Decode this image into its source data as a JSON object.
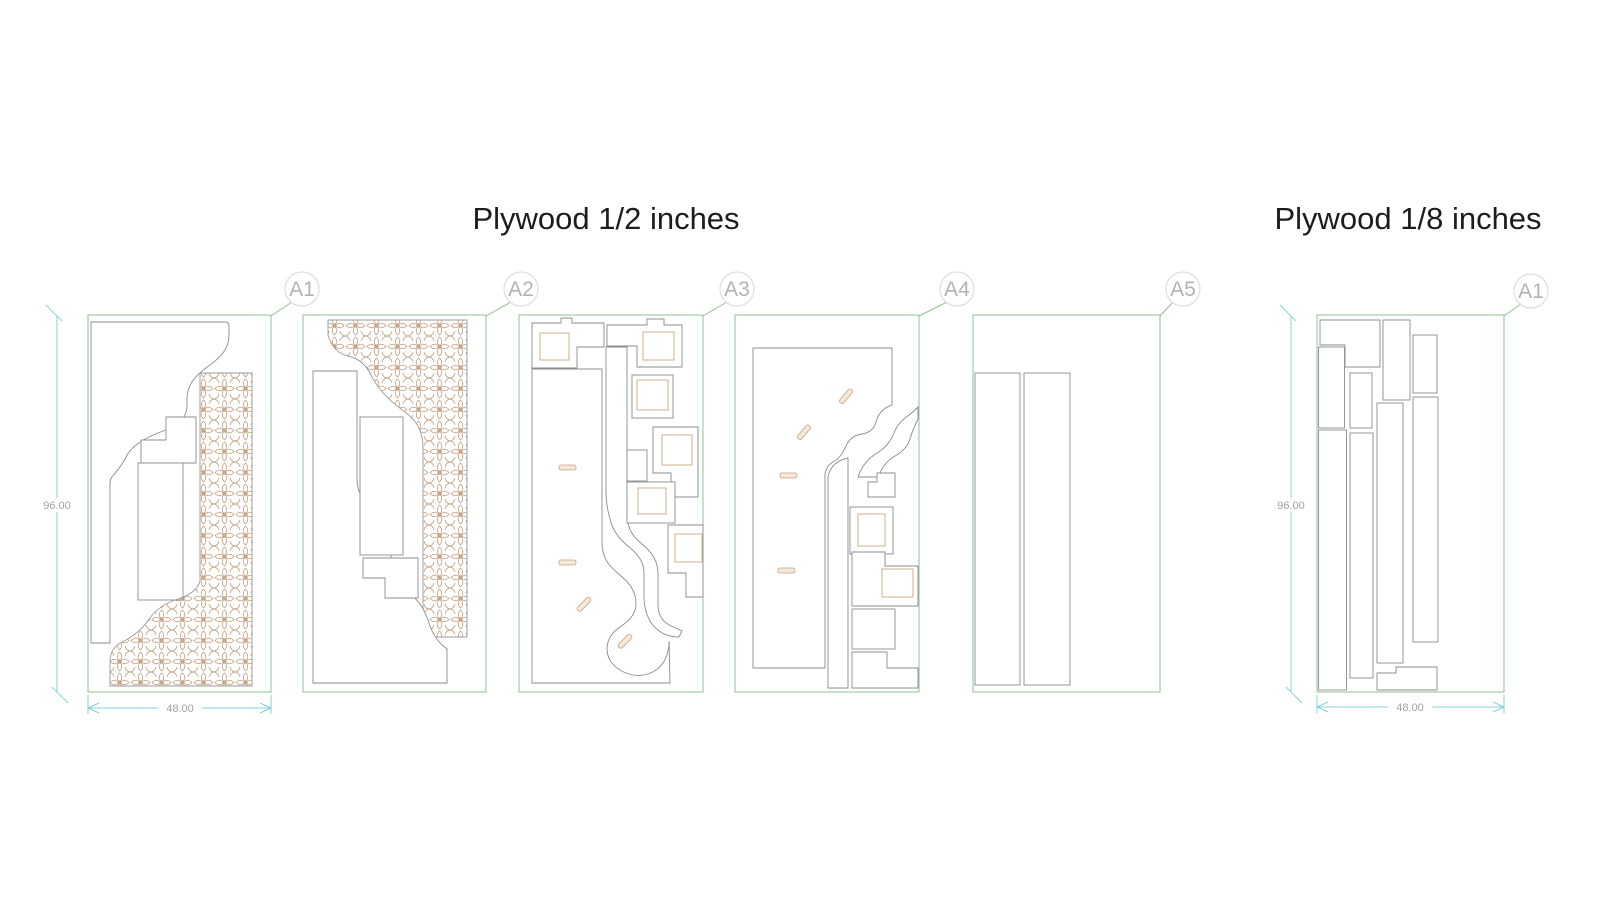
{
  "titles": {
    "left": "Plywood 1/2 inches",
    "right": "Plywood 1/8 inches"
  },
  "sheets": [
    {
      "id": "a1",
      "label": "A1",
      "group": "plywood-half-inch"
    },
    {
      "id": "a2",
      "label": "A2",
      "group": "plywood-half-inch"
    },
    {
      "id": "a3",
      "label": "A3",
      "group": "plywood-half-inch"
    },
    {
      "id": "a4",
      "label": "A4",
      "group": "plywood-half-inch"
    },
    {
      "id": "a5",
      "label": "A5",
      "group": "plywood-half-inch"
    },
    {
      "id": "r1",
      "label": "A1",
      "group": "plywood-eighth-inch"
    }
  ],
  "dimensions": {
    "sheet_height": "96.00",
    "sheet_width": "48.00"
  },
  "colors": {
    "sheet_border": "#8fc191",
    "part_outline": "#8c8c8c",
    "ornament": "#c19a78",
    "stick_fill": "#f3e8da",
    "dimension_line": "#84d2d4",
    "dimension_text": "#a2a2a2",
    "label_text": "#b3b3b3",
    "label_circle": "#dedede",
    "title_text": "#1c1c1c"
  }
}
